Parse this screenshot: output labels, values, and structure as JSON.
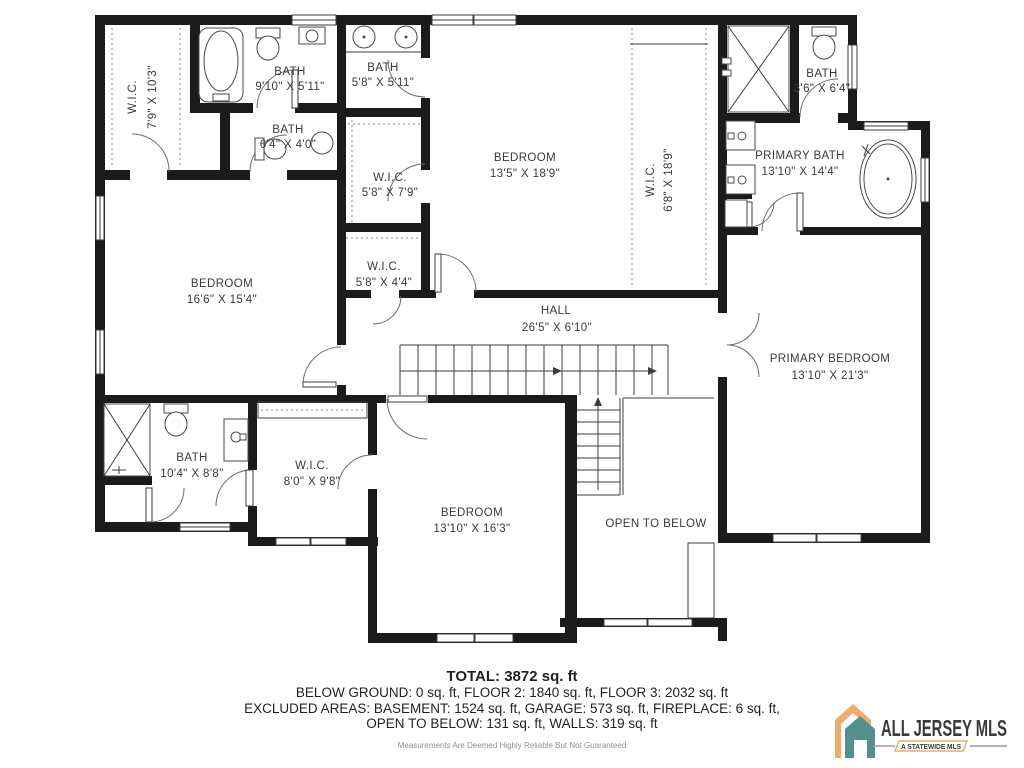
{
  "plan": {
    "rooms": [
      {
        "name": "W.I.C.",
        "dims": "7'9\" X 10'3\""
      },
      {
        "name": "BATH",
        "dims": "9'10\" X 5'11\""
      },
      {
        "name": "BATH",
        "dims": "5'8\" X 5'11\""
      },
      {
        "name": "BATH",
        "dims": "6'4\" X 4'0\""
      },
      {
        "name": "W.I.C.",
        "dims": "5'8\" X 7'9\""
      },
      {
        "name": "BEDROOM",
        "dims": "13'5\" X 18'9\""
      },
      {
        "name": "W.I.C.",
        "dims": "6'8\" X 18'9\""
      },
      {
        "name": "BATH",
        "dims": "3'6\" X 6'4\""
      },
      {
        "name": "PRIMARY BATH",
        "dims": "13'10\" X 14'4\""
      },
      {
        "name": "BEDROOM",
        "dims": "16'6\" X 15'4\""
      },
      {
        "name": "W.I.C.",
        "dims": "5'8\" X 4'4\""
      },
      {
        "name": "HALL",
        "dims": "26'5\" X 6'10\""
      },
      {
        "name": "PRIMARY BEDROOM",
        "dims": "13'10\" X 21'3\""
      },
      {
        "name": "BATH",
        "dims": "10'4\" X 8'8\""
      },
      {
        "name": "W.I.C.",
        "dims": "8'0\" X 9'8\""
      },
      {
        "name": "BEDROOM",
        "dims": "13'10\" X 16'3\""
      },
      {
        "name": "OPEN TO BELOW",
        "dims": ""
      }
    ]
  },
  "summary": {
    "total": "TOTAL: 3872 sq. ft",
    "line1": "BELOW GROUND: 0 sq. ft, FLOOR 2: 1840 sq. ft, FLOOR 3: 2032 sq. ft",
    "line2": "EXCLUDED AREAS: BASEMENT: 1524 sq. ft, GARAGE: 573 sq. ft, FIREPLACE: 6 sq. ft,",
    "line3": "OPEN TO BELOW: 131 sq. ft, WALLS: 319 sq. ft",
    "disclaimer": "Measurements Are Deemed Highly Reliable But Not Guaranteed"
  },
  "logo": {
    "name": "ALL JERSEY MLS",
    "tagline": "A STATEWIDE MLS",
    "colors": {
      "orange": "#edab6e",
      "teal": "#578f8e",
      "gray": "#8a8a8a"
    }
  }
}
